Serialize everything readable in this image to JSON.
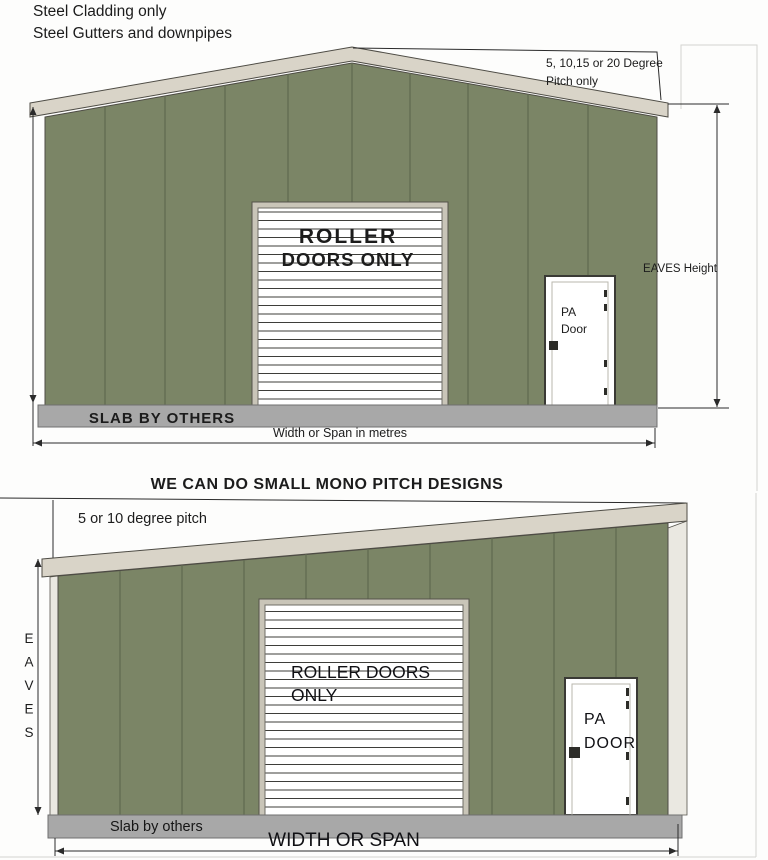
{
  "header": {
    "line1": "Steel Cladding only",
    "line2": "Steel Gutters and downpipes"
  },
  "top_building": {
    "pitch_note_line1": "5, 10,15 or 20 Degree",
    "pitch_note_line2": "Pitch only",
    "eaves_height_label": "EAVES Height",
    "roller_door_label_line1": "ROLLER",
    "roller_door_label_line2": "DOORS ONLY",
    "pa_door_label_line1": "PA",
    "pa_door_label_line2": "Door",
    "slab_label": "SLAB BY OTHERS",
    "width_label": "Width or Span in metres"
  },
  "bottom_building": {
    "title": "WE CAN DO SMALL MONO PITCH DESIGNS",
    "pitch_note": "5 or 10 degree pitch",
    "eaves_label_letters": [
      "E",
      "A",
      "V",
      "E",
      "S"
    ],
    "roller_door_label_line1": "ROLLER DOORS",
    "roller_door_label_line2": "ONLY",
    "pa_door_label_line1": "PA",
    "pa_door_label_line2": "DOOR",
    "slab_label": "Slab by others",
    "width_label": "WIDTH OR SPAN"
  },
  "colors": {
    "wall_green": "#7b8566",
    "fascia_beige": "#d9d4c8",
    "slab_gray": "#a8a8a8",
    "slab_text_gray": "#7d7d7d",
    "roller_text_red": "#c42026",
    "roller_text_dark": "#47474f"
  }
}
